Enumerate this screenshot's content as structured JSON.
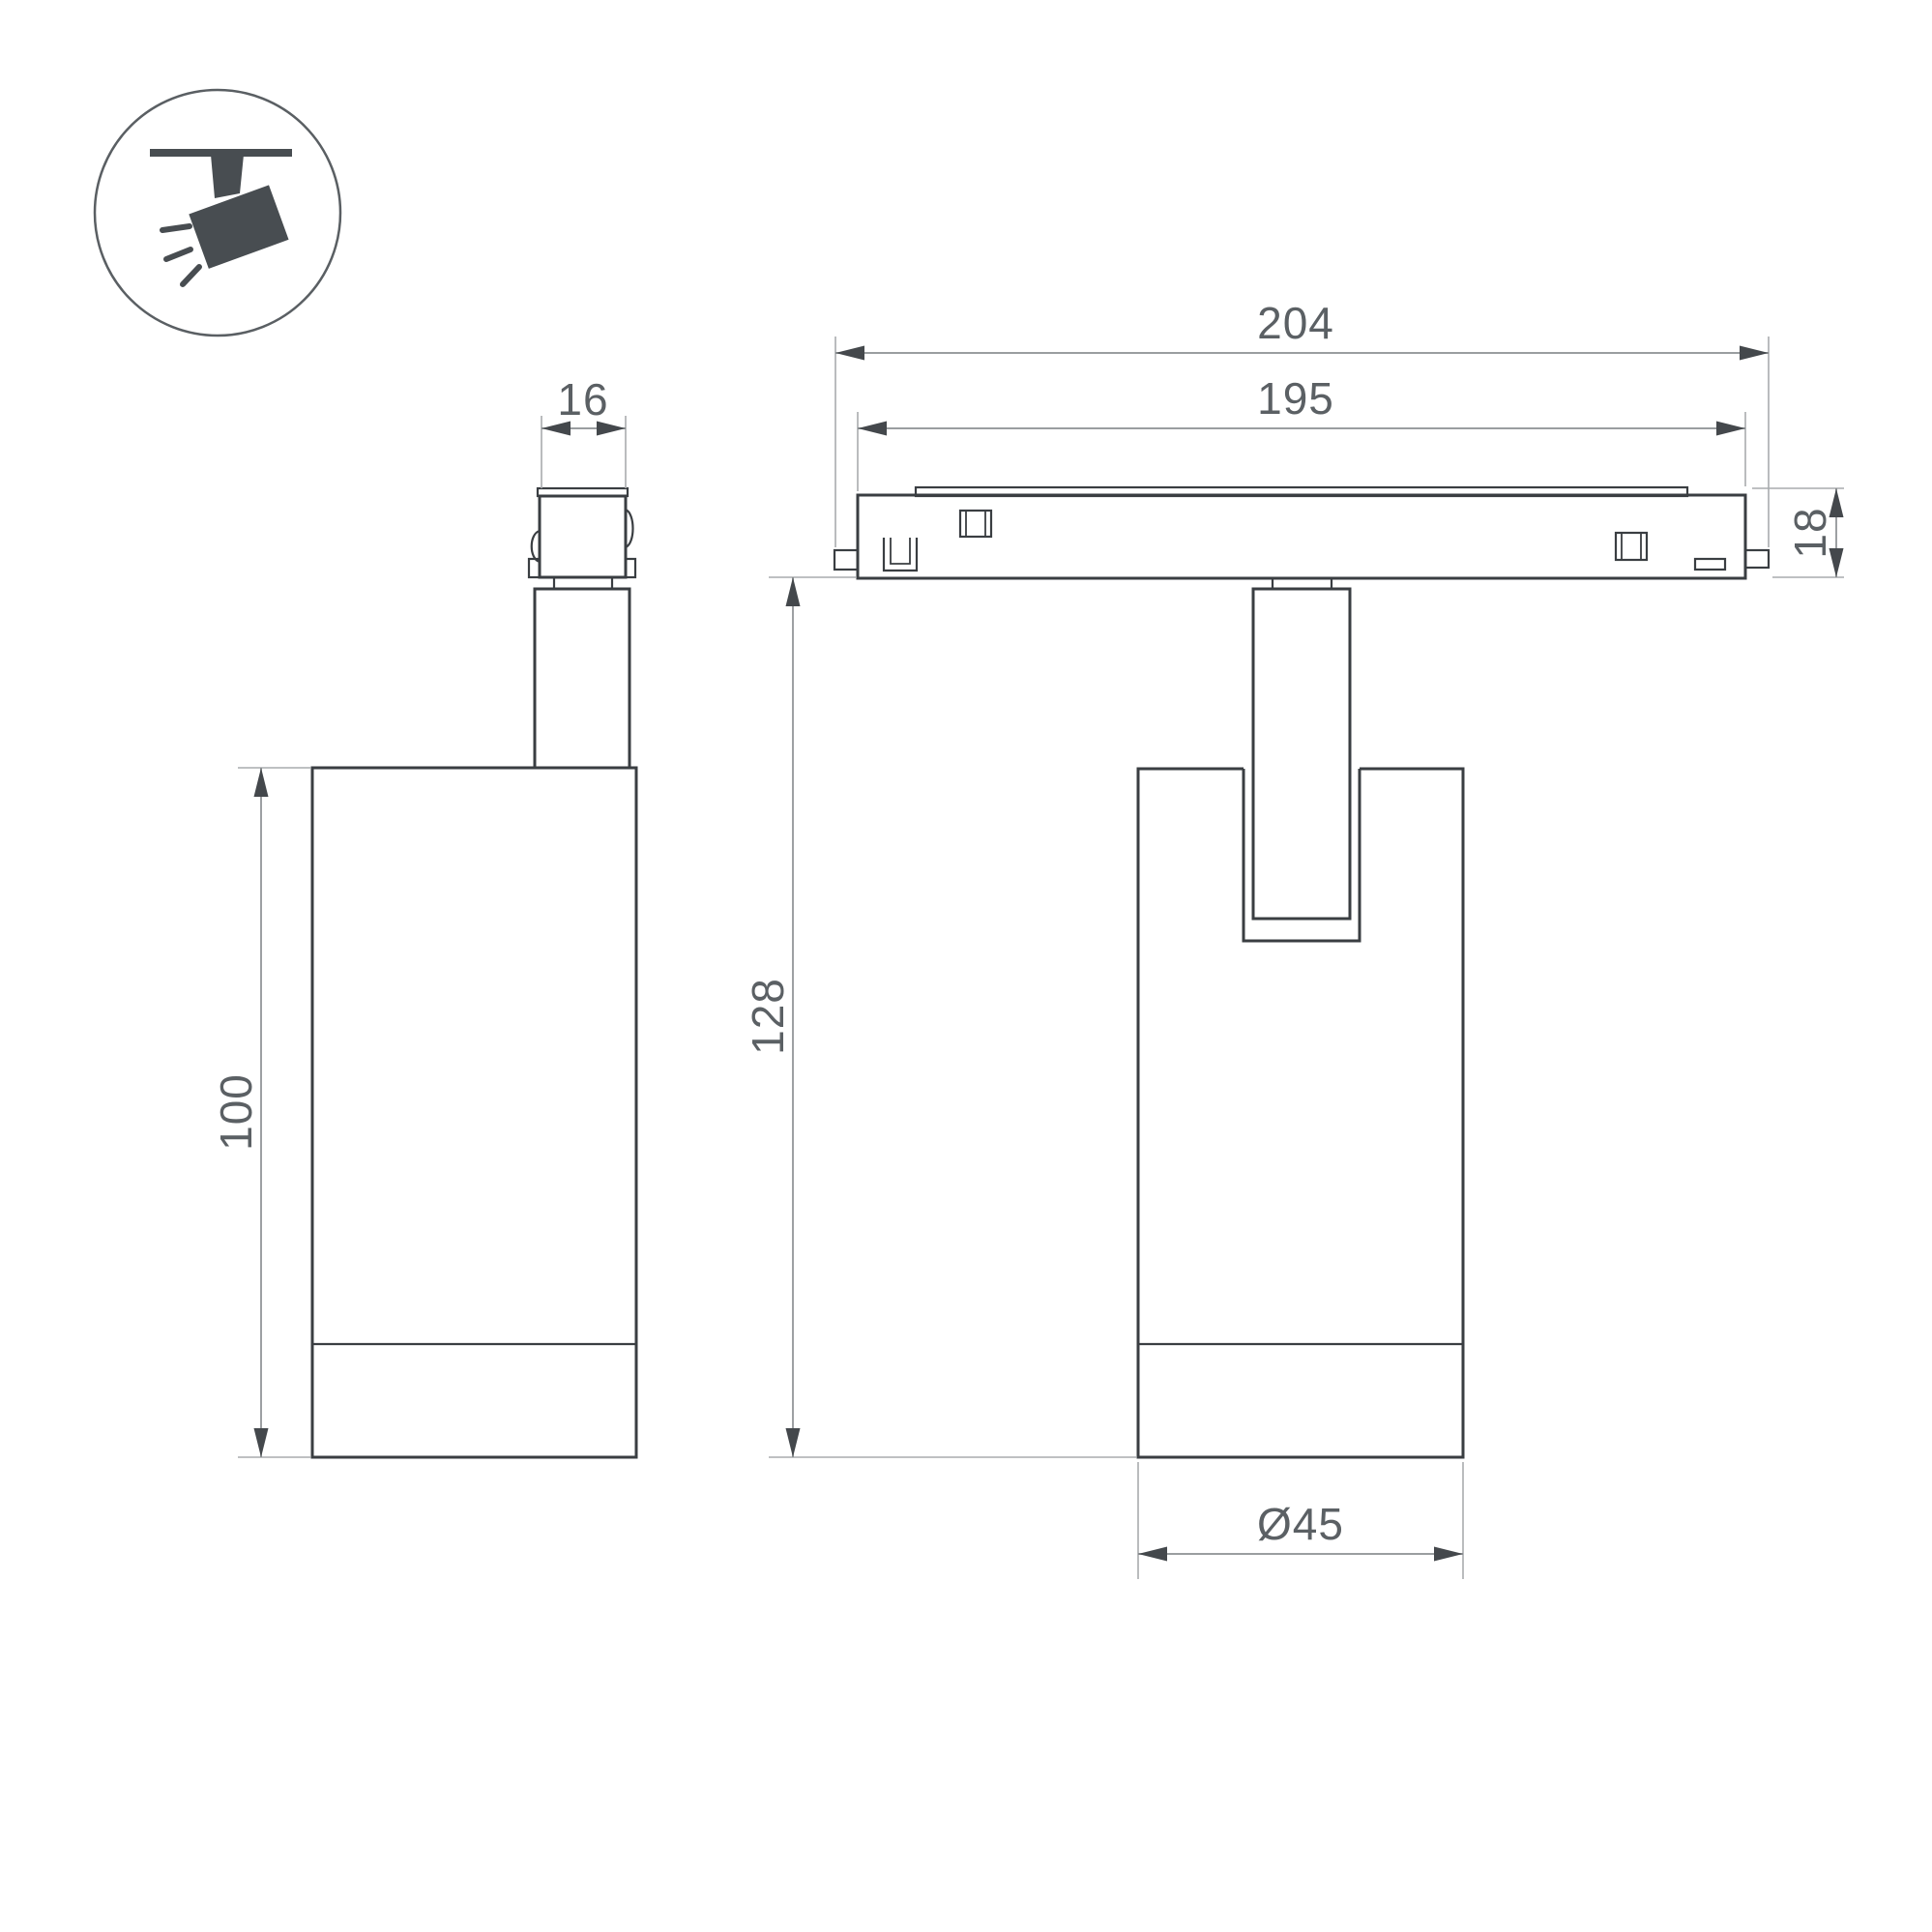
{
  "page": {
    "type": "technical-dimension-drawing",
    "subject": "track-mounted-spotlight-luminaire",
    "background": "#ffffff"
  },
  "icon_badge": {
    "icon": "ceiling-track-spotlight-icon",
    "description": "pictogram of a spotlight hanging from a ceiling track, tilted, with light rays"
  },
  "colors": {
    "outline": "#3a3e42",
    "dimension_line": "#8c9093",
    "extension_line": "#a8abae",
    "arrow": "#44484c",
    "text": "#5b6064",
    "icon_fill": "#484d51"
  },
  "views": {
    "side_view": {
      "dimensions": {
        "connector_width": "16",
        "body_height": "100"
      }
    },
    "front_view": {
      "dimensions": {
        "overall_length": "204",
        "track_body_length": "195",
        "track_height": "18",
        "overall_height": "128",
        "body_diameter": "Ø45"
      }
    }
  }
}
